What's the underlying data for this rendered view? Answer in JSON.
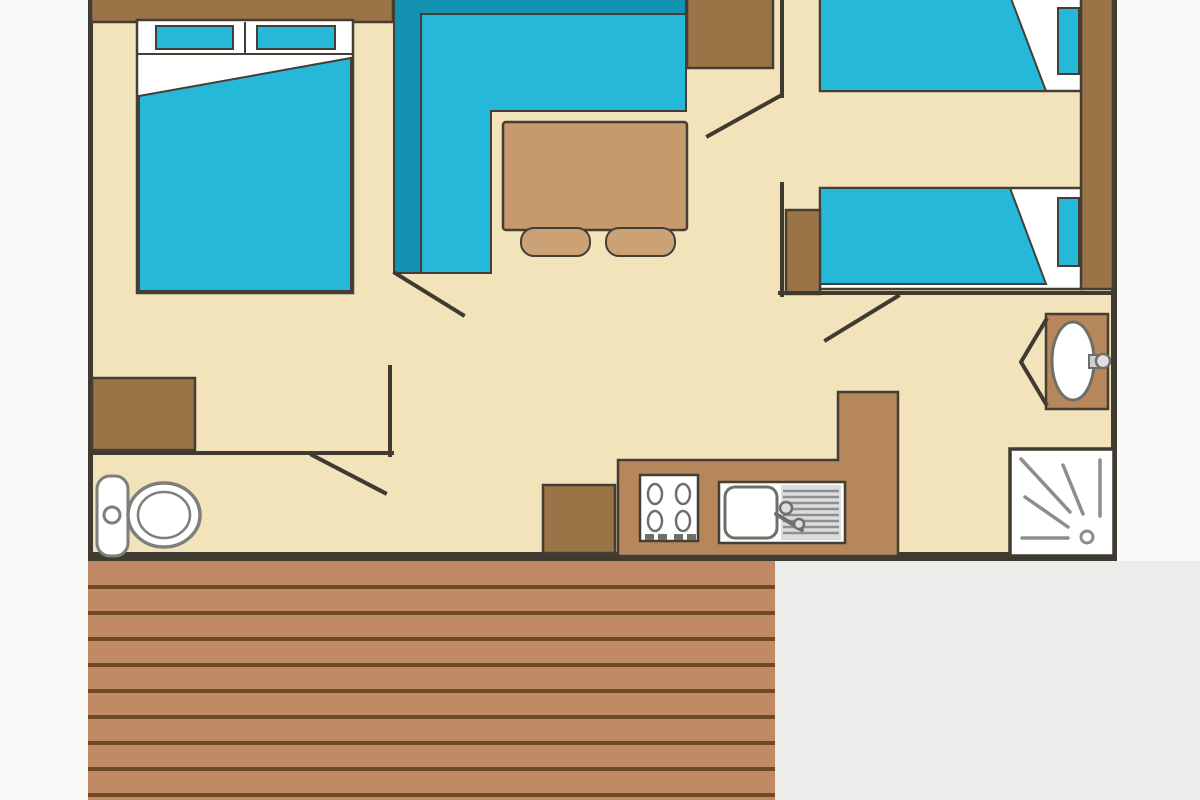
{
  "scene": {
    "type": "floor-plan",
    "subject": "mobile-home-layout-with-terrace"
  },
  "palette": {
    "background": "#fafaf8",
    "background_shadow": "#ececea",
    "floor": "#f2e3bb",
    "wall": "#403b31",
    "outline": "#433f36",
    "furniture_brown": "#9a7347",
    "counter_brown": "#b5875a",
    "table_tan": "#c69a6c",
    "stool_tan": "#cba176",
    "cushion_cyan": "#26b8d8",
    "sofa_teal": "#1392b1",
    "white": "#ffffff",
    "fixture_gray": "#7e7e7a",
    "ray_gray": "#8e8e88",
    "steel_gray": "#8f8f8f",
    "steel_bg": "#dcdcdc",
    "burner_gray": "#6f6f6a",
    "deck_plank": "#c08a64",
    "deck_line": "#6f4a28"
  },
  "elements": [
    "double-bed",
    "double-bed-pillows",
    "corner-sofa",
    "dining-table",
    "stools",
    "wardrobe-top",
    "wardrobe-left",
    "single-bed-top",
    "single-bed-bottom",
    "headboard-column",
    "nightstand",
    "toilet",
    "kitchen-counter",
    "kitchen-cabinet",
    "stove-hob",
    "kitchen-sink",
    "washbasin",
    "shower-tray",
    "wooden-deck",
    "interior-walls",
    "door-swings"
  ]
}
